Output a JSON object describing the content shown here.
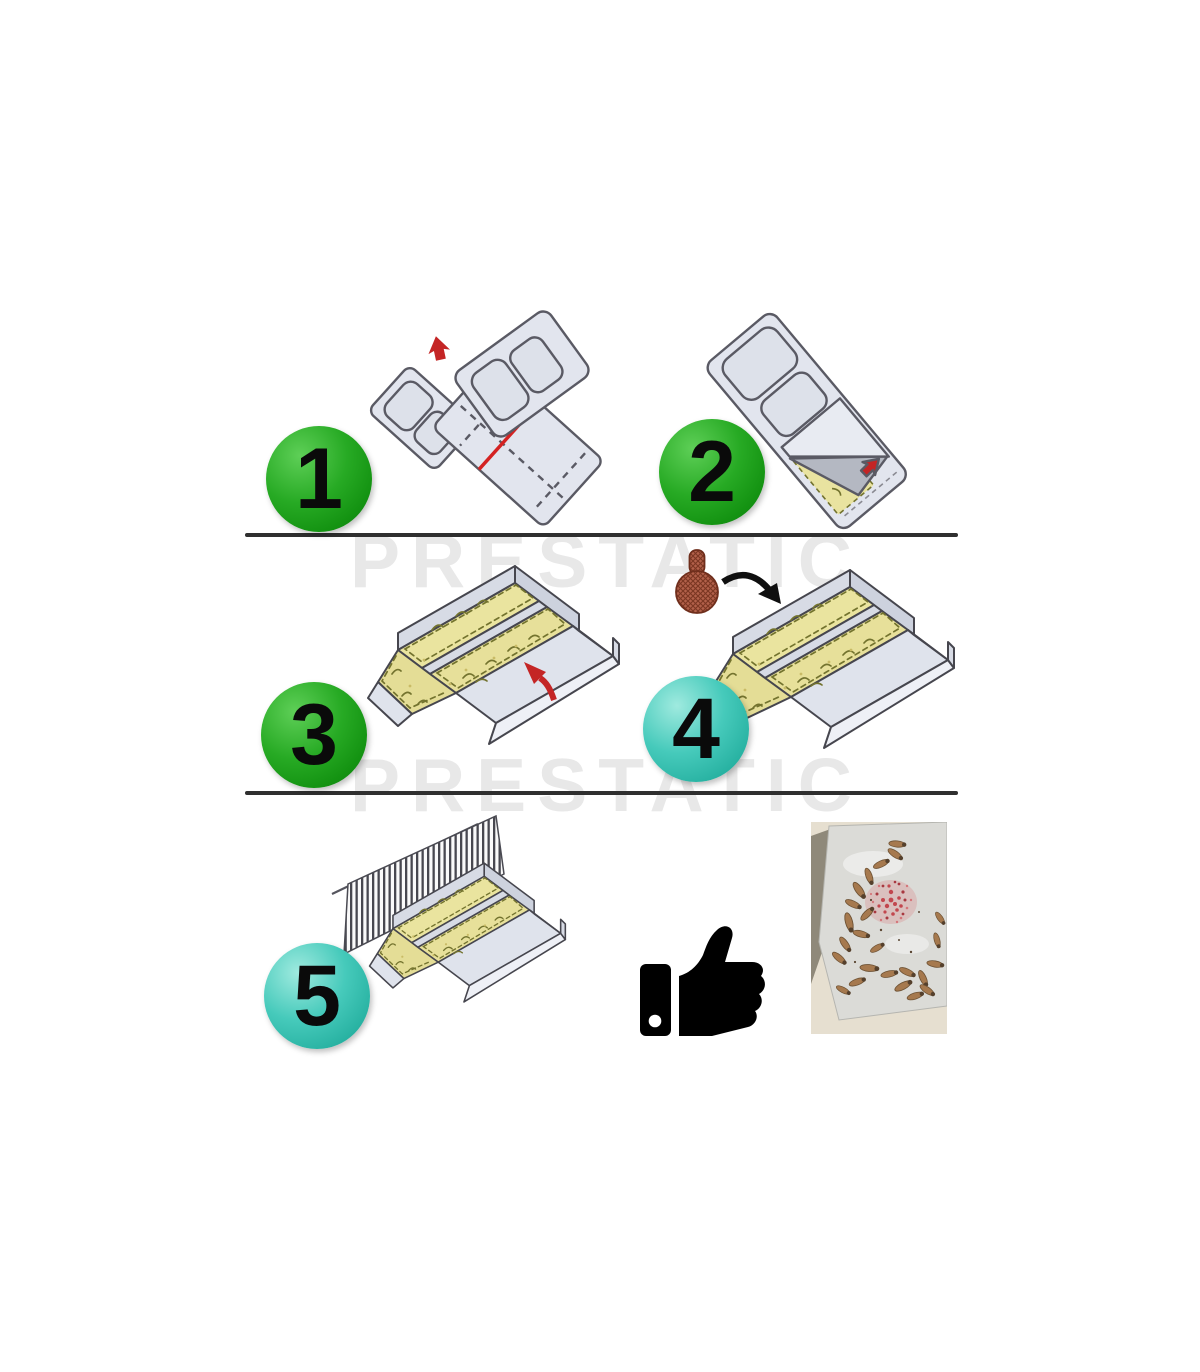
{
  "page": {
    "watermark_text": "PRESTATIC",
    "background": "#ffffff"
  },
  "steps": [
    {
      "number": "1",
      "badge_color": "green",
      "illustration": "unfold-trap-sheet-icon"
    },
    {
      "number": "2",
      "badge_color": "green",
      "illustration": "peel-protective-film-icon"
    },
    {
      "number": "3",
      "badge_color": "green",
      "illustration": "folded-glue-trap-icon"
    },
    {
      "number": "4",
      "badge_color": "teal",
      "illustration": "insert-bait-capsule-icon"
    },
    {
      "number": "5",
      "badge_color": "teal",
      "illustration": "place-trap-against-wall-icon"
    }
  ],
  "result": {
    "thumbs_up_icon": "thumbs-up-icon",
    "photo": "trapped-insects-photo"
  },
  "colors": {
    "badge_green": "#1da31e",
    "badge_teal": "#3cc6b6",
    "number_black": "#0a0a0a",
    "divider": "#2f2f2f",
    "sheet_gray": "#e2e5ee",
    "glue_yellow": "#e9e3a0",
    "accent_red": "#c42525",
    "bait_brown": "#b2604a",
    "insect_brown": "#a6794e",
    "granules_red": "#c2474e",
    "watermark_gray": "#e8e8e8"
  }
}
